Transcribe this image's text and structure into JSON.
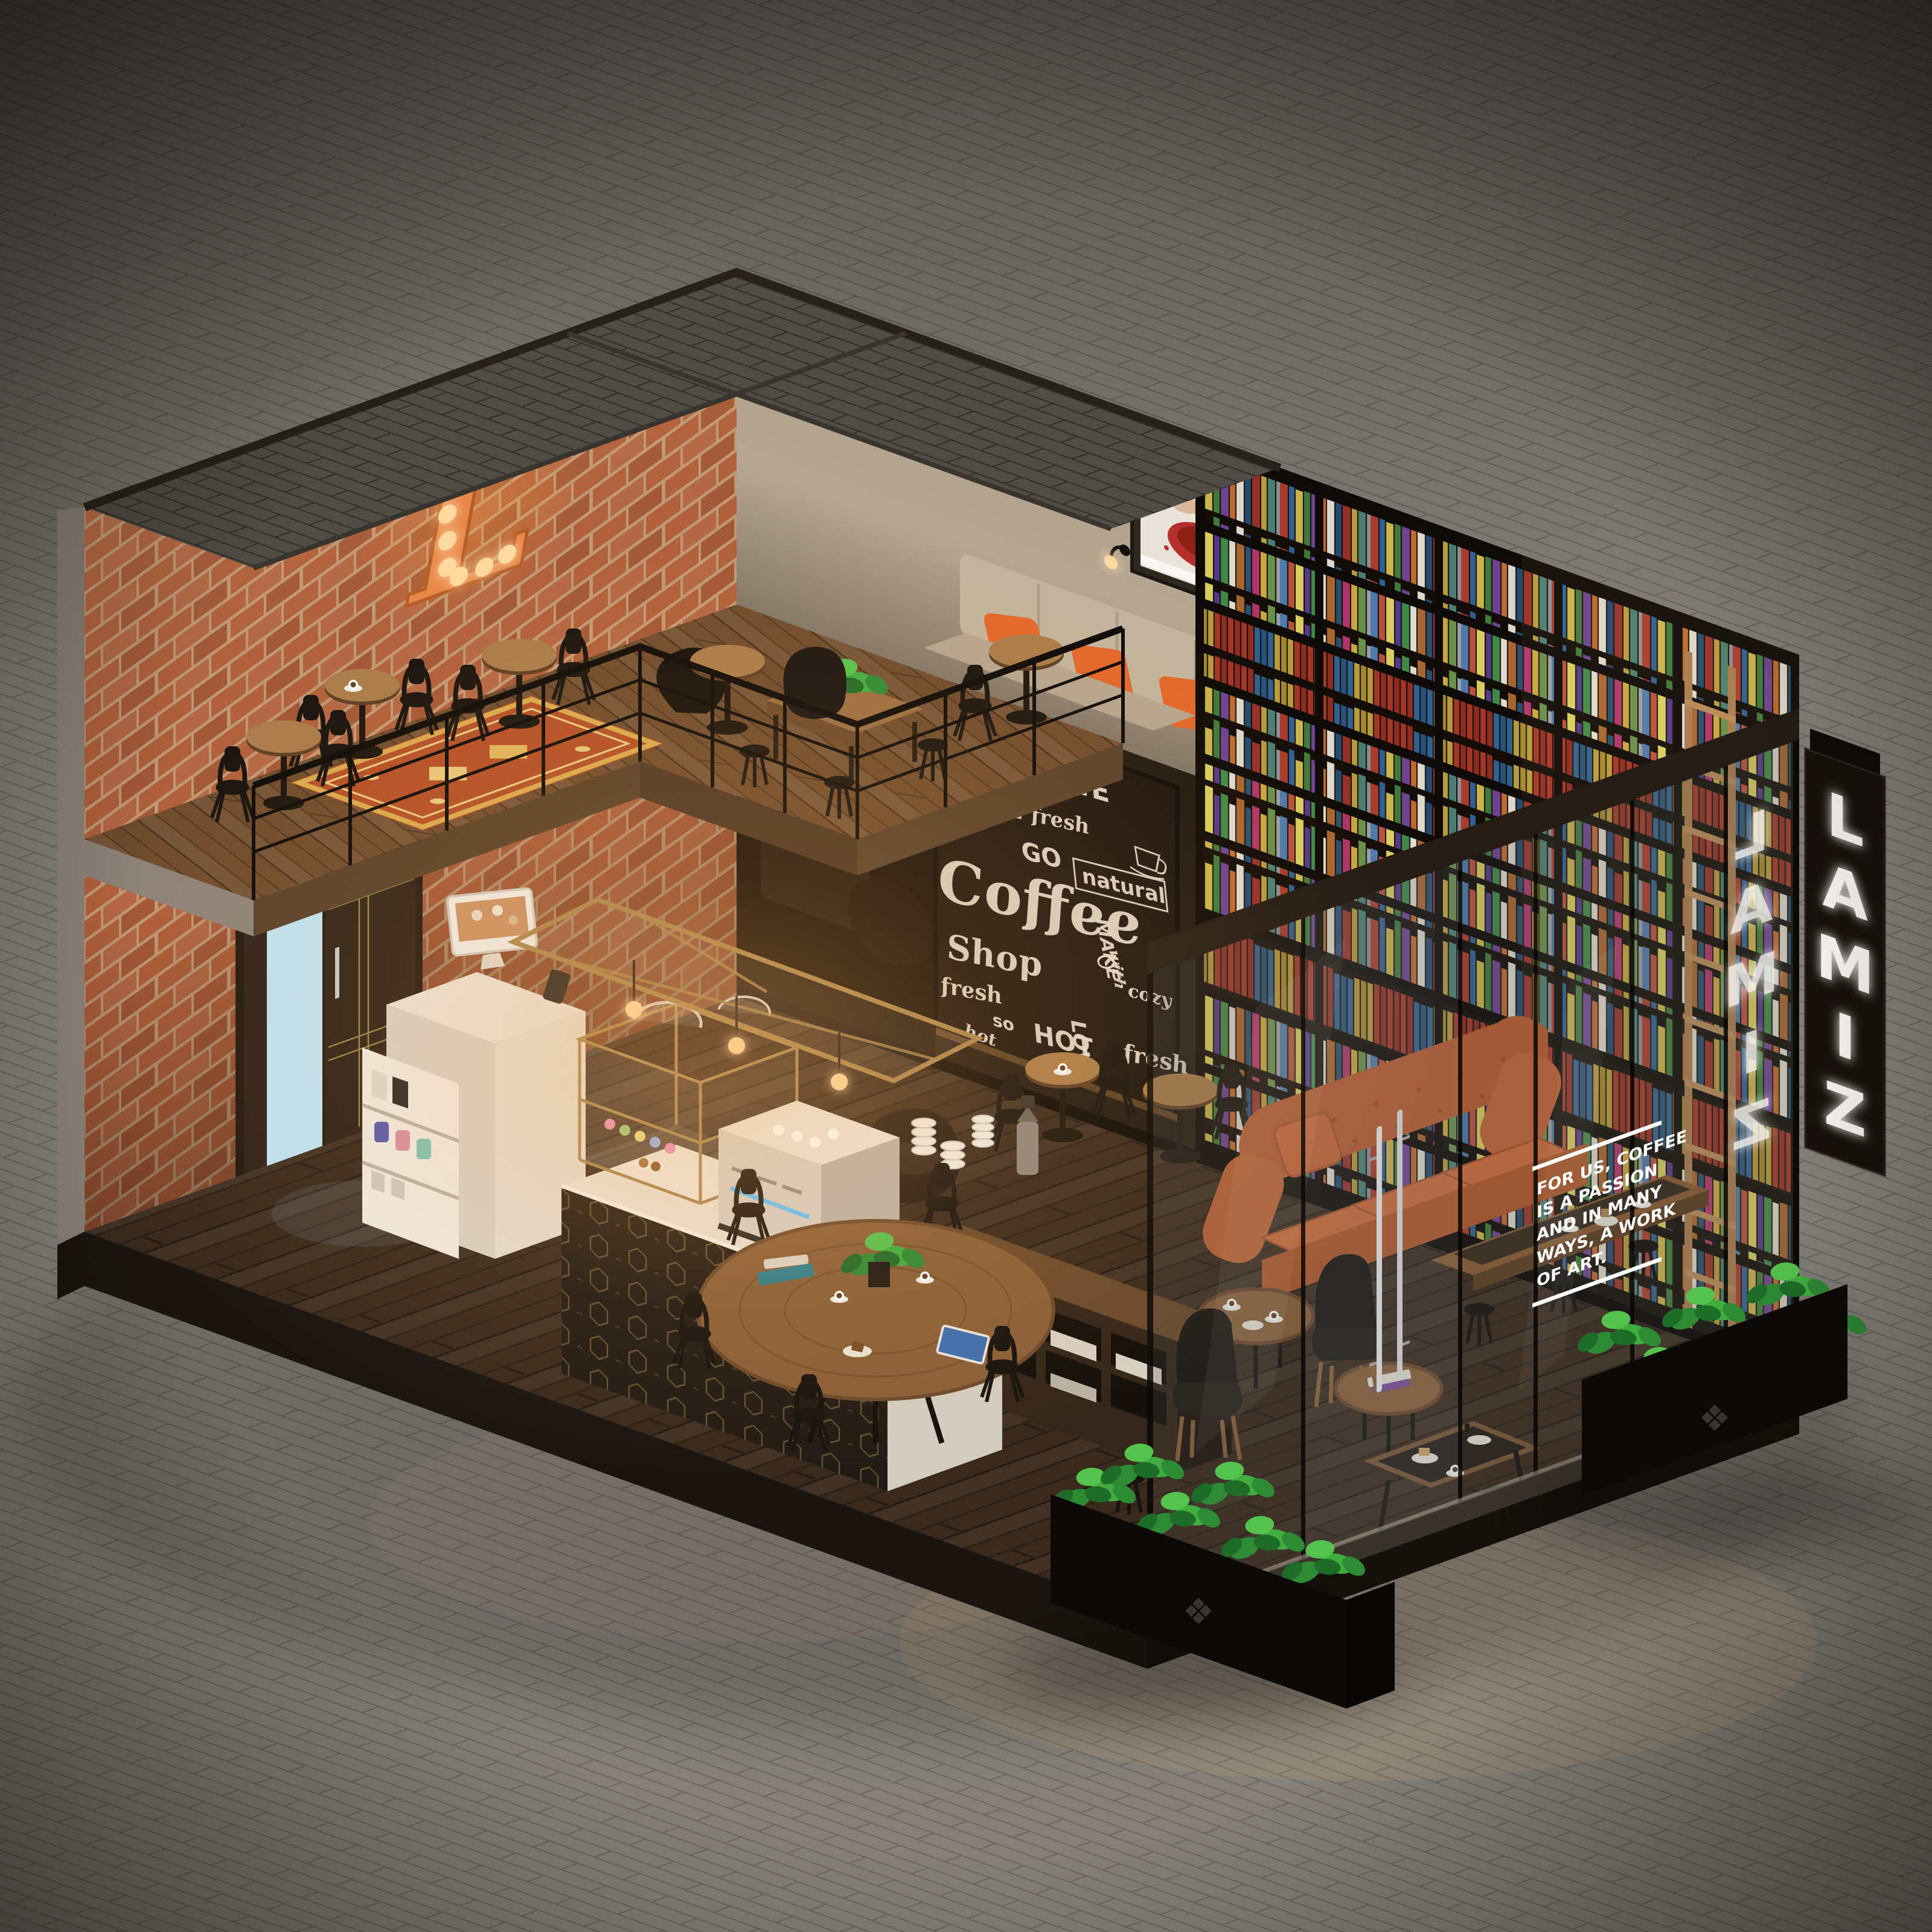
{
  "signs": {
    "blade": {
      "brand": "LAMIZ",
      "letters": [
        "L",
        "A",
        "M",
        "I",
        "Z"
      ]
    },
    "reflection": {
      "letters": [
        "L",
        "A",
        "M",
        "I",
        "Z"
      ]
    },
    "marquee_letter": "L"
  },
  "glass_decal": {
    "lines": [
      "FOR US, COFFEE",
      "IS A PASSION",
      "AND IN MANY",
      "WAYS, A WORK",
      "OF ART."
    ]
  },
  "chalkboard": {
    "words": [
      "COFFEE",
      "2 fresh",
      "GO",
      "Coffee",
      "Shop",
      "MAKE",
      "with",
      "natural",
      "cozy",
      "fresh",
      "so",
      "HOT",
      "LOVE",
      "hot",
      "fresh"
    ]
  },
  "decor": {
    "planter_ornament_icon": "❖"
  },
  "palette": {
    "paver": "#85817a",
    "paver_line": "#575249",
    "wall_ext": "#8d837a",
    "brick": "#b4613c",
    "mortar": "#c59b77",
    "wood_floor": "#3a2a1d",
    "wood_mezz": "#6e4b2d",
    "slate": "#504c47",
    "chalkboard": "#1c150f",
    "chalk": "#e8decf",
    "beige_wall": "#b7a893",
    "banquette": "#c3b49e",
    "pillow": "#e2672a",
    "sofa": "#c4602f",
    "rug": "#b34f28",
    "rug_border": "#d9a94e",
    "counter": "#e8e1d5",
    "gold": "#a8854c",
    "leaf": "#3fae3f",
    "sign_panel": "#16110d",
    "sign_text": "#f8f6f2",
    "bulb": "#ffd9a0",
    "chair": "#17130f",
    "door_glow": "#bfe3f2",
    "book_frame": "#0d0a07"
  }
}
